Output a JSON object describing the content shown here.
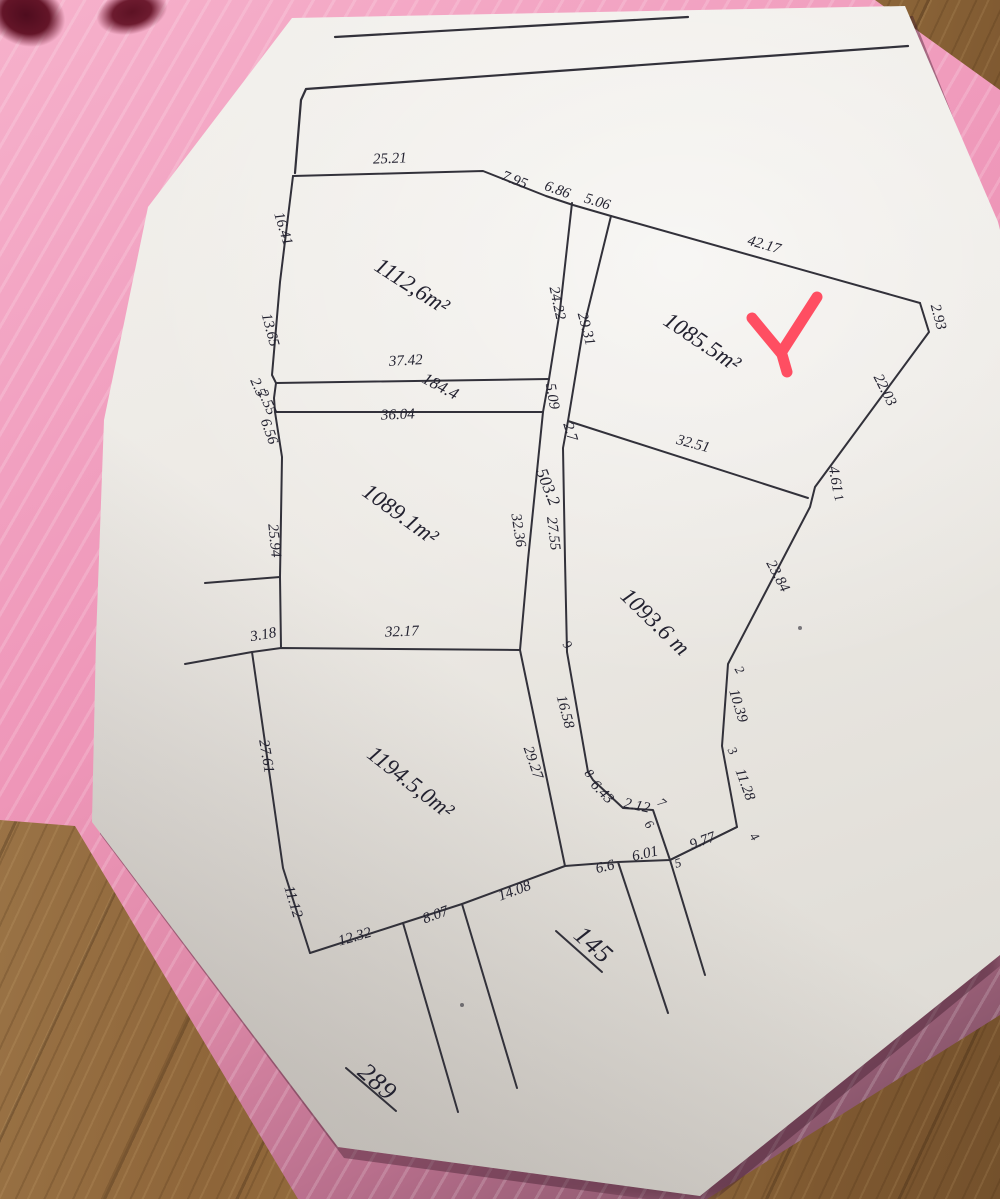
{
  "colors": {
    "pen_ink": "#32313a",
    "label_ink": "#232230",
    "paper": "#ece9e4",
    "folder_pink": "#f0a2c2",
    "folder_pink_shadow": "#8f5b73",
    "wood_brown": "#8e683d",
    "red_mark": "#ff4056",
    "stain_maroon": "#64152a"
  },
  "diagram": {
    "parcel_areas": [
      "1112,6m²",
      "1085.5m²",
      "1089.1m²",
      "1093.6 m",
      "1194.5,0m²",
      "503.2",
      "184.4"
    ],
    "road_numbers": [
      "145",
      "289"
    ],
    "labels": [
      {
        "t": "25.21",
        "x": 390,
        "y": 163,
        "r": -2,
        "k": "edge"
      },
      {
        "t": "7.95",
        "x": 513,
        "y": 184,
        "r": 21,
        "k": "edge"
      },
      {
        "t": "6.86",
        "x": 556,
        "y": 194,
        "r": 20,
        "k": "edge"
      },
      {
        "t": "5.06",
        "x": 596,
        "y": 206,
        "r": 17,
        "k": "edge"
      },
      {
        "t": "42.17",
        "x": 763,
        "y": 249,
        "r": 16,
        "k": "edge"
      },
      {
        "t": "2.93",
        "x": 934,
        "y": 318,
        "r": 75,
        "k": "edge"
      },
      {
        "t": "22.03",
        "x": 881,
        "y": 392,
        "r": 63,
        "k": "edge"
      },
      {
        "t": "4.61",
        "x": 831,
        "y": 480,
        "r": 80,
        "k": "edge"
      },
      {
        "t": "23.84",
        "x": 774,
        "y": 578,
        "r": 62,
        "k": "edge"
      },
      {
        "t": "10.39",
        "x": 734,
        "y": 707,
        "r": 73,
        "k": "edge"
      },
      {
        "t": "11.28",
        "x": 741,
        "y": 786,
        "r": 70,
        "k": "edge"
      },
      {
        "t": "9.77",
        "x": 704,
        "y": 845,
        "r": -20,
        "k": "edge"
      },
      {
        "t": "6.01",
        "x": 646,
        "y": 858,
        "r": -13,
        "k": "edge"
      },
      {
        "t": "6.6",
        "x": 606,
        "y": 871,
        "r": -13,
        "k": "edge"
      },
      {
        "t": "14.08",
        "x": 516,
        "y": 895,
        "r": -20,
        "k": "edge"
      },
      {
        "t": "8.07",
        "x": 437,
        "y": 919,
        "r": -20,
        "k": "edge"
      },
      {
        "t": "12.32",
        "x": 356,
        "y": 941,
        "r": -16,
        "k": "edge"
      },
      {
        "t": "11.12",
        "x": 289,
        "y": 903,
        "r": 73,
        "k": "edge"
      },
      {
        "t": "27.61",
        "x": 262,
        "y": 757,
        "r": 80,
        "k": "edge"
      },
      {
        "t": "3.18",
        "x": 264,
        "y": 639,
        "r": -10,
        "k": "edge"
      },
      {
        "t": "32.17",
        "x": 402,
        "y": 636,
        "r": -2,
        "k": "edge"
      },
      {
        "t": "25.94",
        "x": 270,
        "y": 541,
        "r": 84,
        "k": "edge"
      },
      {
        "t": "6.56",
        "x": 265,
        "y": 433,
        "r": 70,
        "k": "edge"
      },
      {
        "t": "2.55",
        "x": 263,
        "y": 404,
        "r": 66,
        "k": "edge"
      },
      {
        "t": "2.5",
        "x": 254,
        "y": 389,
        "r": 66,
        "k": "edge"
      },
      {
        "t": "13.65",
        "x": 266,
        "y": 331,
        "r": 75,
        "k": "edge"
      },
      {
        "t": "16.41",
        "x": 279,
        "y": 230,
        "r": 73,
        "k": "edge"
      },
      {
        "t": "37.42",
        "x": 406,
        "y": 365,
        "r": -3,
        "k": "edge"
      },
      {
        "t": "36.04",
        "x": 398,
        "y": 419,
        "r": -2,
        "k": "edge"
      },
      {
        "t": "24.22",
        "x": 553,
        "y": 304,
        "r": 78,
        "k": "edge"
      },
      {
        "t": "29.31",
        "x": 582,
        "y": 330,
        "r": 75,
        "k": "edge"
      },
      {
        "t": "5.09",
        "x": 548,
        "y": 397,
        "r": 80,
        "k": "edge"
      },
      {
        "t": "2.7",
        "x": 566,
        "y": 433,
        "r": 73,
        "k": "edge"
      },
      {
        "t": "32.36",
        "x": 514,
        "y": 531,
        "r": 81,
        "k": "edge"
      },
      {
        "t": "27.55",
        "x": 549,
        "y": 534,
        "r": 83,
        "k": "edge"
      },
      {
        "t": "32.51",
        "x": 692,
        "y": 448,
        "r": 15,
        "k": "edge"
      },
      {
        "t": "16.58",
        "x": 561,
        "y": 713,
        "r": 75,
        "k": "edge"
      },
      {
        "t": "29.27",
        "x": 529,
        "y": 764,
        "r": 71,
        "k": "edge"
      },
      {
        "t": "6.43",
        "x": 599,
        "y": 795,
        "r": 46,
        "k": "edge"
      },
      {
        "t": "2.12",
        "x": 636,
        "y": 810,
        "r": 12,
        "k": "edge"
      },
      {
        "t": "1112,6m²",
        "x": 408,
        "y": 292,
        "r": 33,
        "k": "parcel"
      },
      {
        "t": "1085.5m²",
        "x": 698,
        "y": 348,
        "r": 34,
        "k": "parcel"
      },
      {
        "t": "1089.1m²",
        "x": 396,
        "y": 520,
        "r": 36,
        "k": "parcel"
      },
      {
        "t": "1093.6 m",
        "x": 650,
        "y": 627,
        "r": 44,
        "k": "parcel"
      },
      {
        "t": "1194.5,0m²",
        "x": 406,
        "y": 788,
        "r": 38,
        "k": "parcel"
      },
      {
        "t": "503.2",
        "x": 543,
        "y": 489,
        "r": 68,
        "k": "strip"
      },
      {
        "t": "184.4",
        "x": 438,
        "y": 391,
        "r": 28,
        "k": "strip"
      },
      {
        "t": "145",
        "x": 588,
        "y": 951,
        "r": 42,
        "k": "road"
      },
      {
        "t": "289",
        "x": 372,
        "y": 1088,
        "r": 42,
        "k": "road"
      },
      {
        "t": "1",
        "x": 835,
        "y": 499,
        "r": 70,
        "k": "vertex"
      },
      {
        "t": "2",
        "x": 736,
        "y": 672,
        "r": 60,
        "k": "vertex"
      },
      {
        "t": "3",
        "x": 729,
        "y": 753,
        "r": 60,
        "k": "vertex"
      },
      {
        "t": "4",
        "x": 751,
        "y": 839,
        "r": 55,
        "k": "vertex"
      },
      {
        "t": "5",
        "x": 679,
        "y": 867,
        "r": -15,
        "k": "vertex"
      },
      {
        "t": "6",
        "x": 646,
        "y": 827,
        "r": 50,
        "k": "vertex"
      },
      {
        "t": "7",
        "x": 659,
        "y": 806,
        "r": 40,
        "k": "vertex"
      },
      {
        "t": "8",
        "x": 586,
        "y": 776,
        "r": 50,
        "k": "vertex"
      },
      {
        "t": "9",
        "x": 564,
        "y": 647,
        "r": 55,
        "k": "vertex"
      }
    ],
    "polylines": [
      {
        "name": "road-top",
        "w": 2.2,
        "pts": [
          [
            335,
            37
          ],
          [
            688,
            17
          ]
        ]
      },
      {
        "name": "outer-top",
        "w": 2.2,
        "pts": [
          [
            295,
            173
          ],
          [
            301,
            100
          ],
          [
            306,
            89
          ],
          [
            908,
            46
          ]
        ]
      },
      {
        "name": "parcel-top",
        "pts": [
          [
            293,
            176
          ],
          [
            483,
            171
          ],
          [
            546,
            196
          ],
          [
            573,
            205
          ],
          [
            611,
            216
          ],
          [
            920,
            303
          ]
        ]
      },
      {
        "name": "boundary-right",
        "pts": [
          [
            920,
            303
          ],
          [
            929,
            332
          ],
          [
            815,
            487
          ],
          [
            810,
            507
          ],
          [
            728,
            664
          ],
          [
            722,
            746
          ],
          [
            737,
            827
          ],
          [
            670,
            860
          ]
        ]
      },
      {
        "name": "road-bottom",
        "pts": [
          [
            737,
            827
          ],
          [
            670,
            860
          ],
          [
            618,
            862
          ],
          [
            565,
            866
          ],
          [
            462,
            904
          ],
          [
            403,
            923
          ],
          [
            310,
            953
          ]
        ]
      },
      {
        "name": "west-1194",
        "pts": [
          [
            310,
            953
          ],
          [
            283,
            868
          ],
          [
            252,
            652
          ]
        ]
      },
      {
        "name": "stub-west-1194",
        "pts": [
          [
            252,
            652
          ],
          [
            185,
            664
          ]
        ]
      },
      {
        "name": "south-1089",
        "pts": [
          [
            252,
            652
          ],
          [
            281,
            648
          ],
          [
            520,
            650
          ]
        ]
      },
      {
        "name": "west-upper",
        "pts": [
          [
            293,
            176
          ],
          [
            280,
            282
          ],
          [
            272,
            375
          ],
          [
            276,
            383
          ],
          [
            274,
            398
          ],
          [
            275,
            412
          ],
          [
            282,
            457
          ],
          [
            280,
            577
          ],
          [
            281,
            648
          ]
        ]
      },
      {
        "name": "stub-west-1089",
        "pts": [
          [
            280,
            577
          ],
          [
            205,
            583
          ]
        ]
      },
      {
        "name": "line-37-42",
        "pts": [
          [
            276,
            383
          ],
          [
            549,
            379
          ]
        ]
      },
      {
        "name": "line-36-04",
        "pts": [
          [
            275,
            412
          ],
          [
            543,
            412
          ]
        ]
      },
      {
        "name": "strip-left",
        "pts": [
          [
            572,
            203
          ],
          [
            560,
            310
          ],
          [
            549,
            379
          ],
          [
            543,
            412
          ],
          [
            528,
            560
          ],
          [
            520,
            650
          ],
          [
            565,
            866
          ]
        ]
      },
      {
        "name": "strip-right",
        "pts": [
          [
            611,
            216
          ],
          [
            583,
            330
          ],
          [
            568,
            421
          ],
          [
            563,
            448
          ],
          [
            565,
            560
          ],
          [
            567,
            652
          ],
          [
            588,
            772
          ],
          [
            593,
            780
          ],
          [
            623,
            808
          ],
          [
            653,
            810
          ],
          [
            670,
            860
          ],
          [
            705,
            975
          ]
        ]
      },
      {
        "name": "line-32-51",
        "pts": [
          [
            568,
            421
          ],
          [
            808,
            498
          ]
        ]
      },
      {
        "name": "neighbor-1",
        "pts": [
          [
            403,
            923
          ],
          [
            458,
            1112
          ]
        ]
      },
      {
        "name": "neighbor-2",
        "pts": [
          [
            462,
            904
          ],
          [
            517,
            1088
          ]
        ]
      },
      {
        "name": "neighbor-3",
        "pts": [
          [
            618,
            862
          ],
          [
            668,
            1013
          ]
        ]
      },
      {
        "name": "underline-145",
        "pts": [
          [
            556,
            931
          ],
          [
            602,
            972
          ]
        ]
      },
      {
        "name": "underline-289",
        "pts": [
          [
            346,
            1068
          ],
          [
            396,
            1111
          ]
        ]
      }
    ],
    "red_check": {
      "path": "M752 318 L781 353 L817 297 M781 351 L787 372",
      "width": 11
    },
    "specks": [
      [
        800,
        628
      ],
      [
        462,
        1005
      ]
    ]
  }
}
